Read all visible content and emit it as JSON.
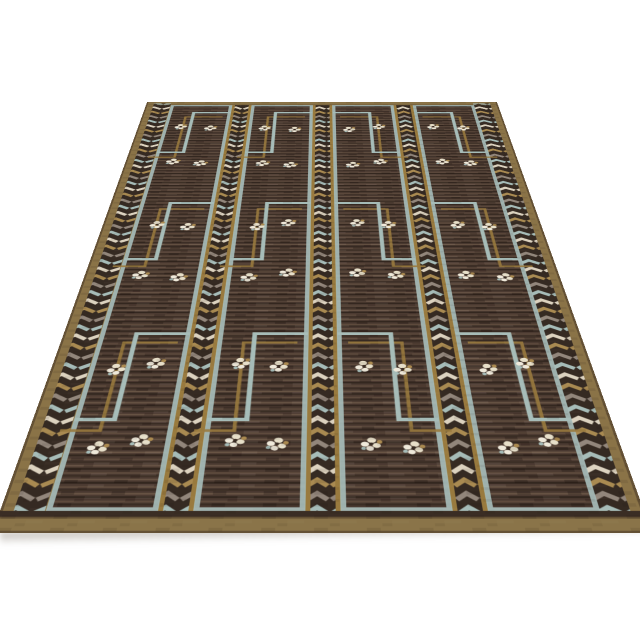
{
  "scene": {
    "description": "Product photograph of a Swedish Deco style flat-weave rug shown at an angled perspective on a plain white background. No text, buttons or UI controls are visible.",
    "background_color": "#ffffff",
    "shadow_color": "rgba(105,94,78,0.42)"
  },
  "rug": {
    "style": "Scandinavian / Swedish Deco style rug with brown ribbed field, pale blue stepped (ziggurat) lines, striped chevron columns and small cream floral motifs",
    "flat_width": 660,
    "flat_height": 1080,
    "projection": {
      "perspective_px": 800,
      "rotate_x_deg": 41.1,
      "bottom_screen_y": 533,
      "center_screen_x": 322
    },
    "palette": {
      "field_base": "#4b3a31",
      "rib_dark": "#33271f",
      "rib_mid": "#3a2d24",
      "rib_light": "#5e4b3d",
      "rib_lighter": "#6b5747",
      "blue_line": "#a6bcb8",
      "gold_line": "#997a3e",
      "gold_border": "#8a7347",
      "gold_bottom": "#8a7449",
      "gold_dark_line": "#645135",
      "band_background": "#352a22",
      "chevron_cream": "#dcd2bf",
      "chevron_blue": "#a6bcb8",
      "chevron_tan": "#a98a51",
      "chevron_gray": "#92867b",
      "flower_cream": "#e7dfc9",
      "flower_white": "#efe9da",
      "flower_gold": "#ab8a50",
      "flower_blue": "#a6bcb8",
      "flower_dark": "#3a2d24"
    },
    "layout": {
      "top_border": {
        "y": 0,
        "h": 16
      },
      "bottom_border": {
        "dark_y": 1050,
        "dark_h": 8,
        "gold_y": 1058,
        "gold_h": 22
      },
      "edge_bands": [
        {
          "x": 14,
          "w": 32
        },
        {
          "x": 614,
          "w": 32
        }
      ],
      "inner_bands": [
        {
          "gold_x": 161,
          "gold_w": 38,
          "chev_x": 167,
          "chev_w": 26
        },
        {
          "gold_x": 312,
          "gold_w": 38,
          "chev_x": 318,
          "chev_w": 26
        },
        {
          "gold_x": 463,
          "gold_w": 38,
          "chev_x": 469,
          "chev_w": 26
        }
      ],
      "panels": [
        {
          "x": 48,
          "w": 113,
          "descend": "left"
        },
        {
          "x": 199,
          "w": 113,
          "descend": "left"
        },
        {
          "x": 350,
          "w": 113,
          "descend": "right"
        },
        {
          "x": 501,
          "w": 113,
          "descend": "right"
        }
      ],
      "panel_y": 16,
      "panel_h": 1034,
      "step_cells": [
        16,
        362,
        708
      ],
      "step_cell_height": 346,
      "step_tread1_dy": 34,
      "step_tread2_dy": 200,
      "step_break_frac": 0.6,
      "step_echo_offset": {
        "dx": 13,
        "dy": 19
      },
      "flower_row_offsets": [
        100,
        240
      ],
      "flower_x_fracs": [
        0.28,
        0.72
      ],
      "line_widths": {
        "blue": 6,
        "gold_echo": 4.5,
        "panel_outline": 6
      }
    },
    "chevron_cycle": [
      "chevron_blue",
      "chevron_cream",
      "chevron_tan",
      "chevron_gray"
    ]
  }
}
